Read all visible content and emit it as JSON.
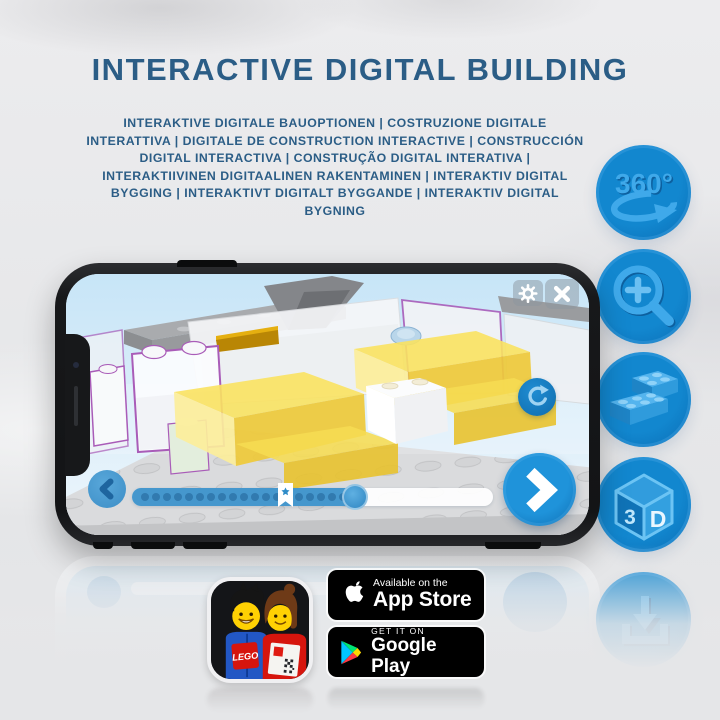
{
  "header": {
    "title": "INTERACTIVE DIGITAL BUILDING",
    "subtitle": "INTERAKTIVE DIGITALE BAUOPTIONEN | COSTRUZIONE DIGITALE INTERATTIVA | DIGITALE DE CONSTRUCTION INTERACTIVE | CONSTRUCCIÓN DIGITAL INTERACTIVA | CONSTRUÇÃO DIGITAL INTERATIVA | INTERAKTIIVINEN DIGITAALINEN RAKENTAMINEN | INTERAKTIV DIGITAL BYGGING | INTERAKTIVT DIGITALT BYGGANDE | INTERAKTIV DIGITAL BYGNING"
  },
  "feature_rail": {
    "items": [
      {
        "id": "rotate-360",
        "label": "360°"
      },
      {
        "id": "zoom-in"
      },
      {
        "id": "lego-brick"
      },
      {
        "id": "cube-3d",
        "face_left": "3",
        "face_right": "D"
      },
      {
        "id": "download"
      }
    ]
  },
  "app_icon": {
    "logo_text": "LEGO"
  },
  "badges": {
    "app_store": {
      "tagline": "Available on the",
      "store": "App Store"
    },
    "google_play": {
      "tagline": "GET IT ON",
      "store": "Google Play"
    }
  },
  "colors": {
    "title_blue": "#2b5d86",
    "icon_circle_blue": "#0d79c0",
    "icon_glyph_blue": "#3fa9ea",
    "screen_button_blue": "#1f8dd2",
    "brick_yellow": "#f6dc4e",
    "ghost_outline_purple": "#a05ab0",
    "background_gray": "#e6e7e9"
  }
}
